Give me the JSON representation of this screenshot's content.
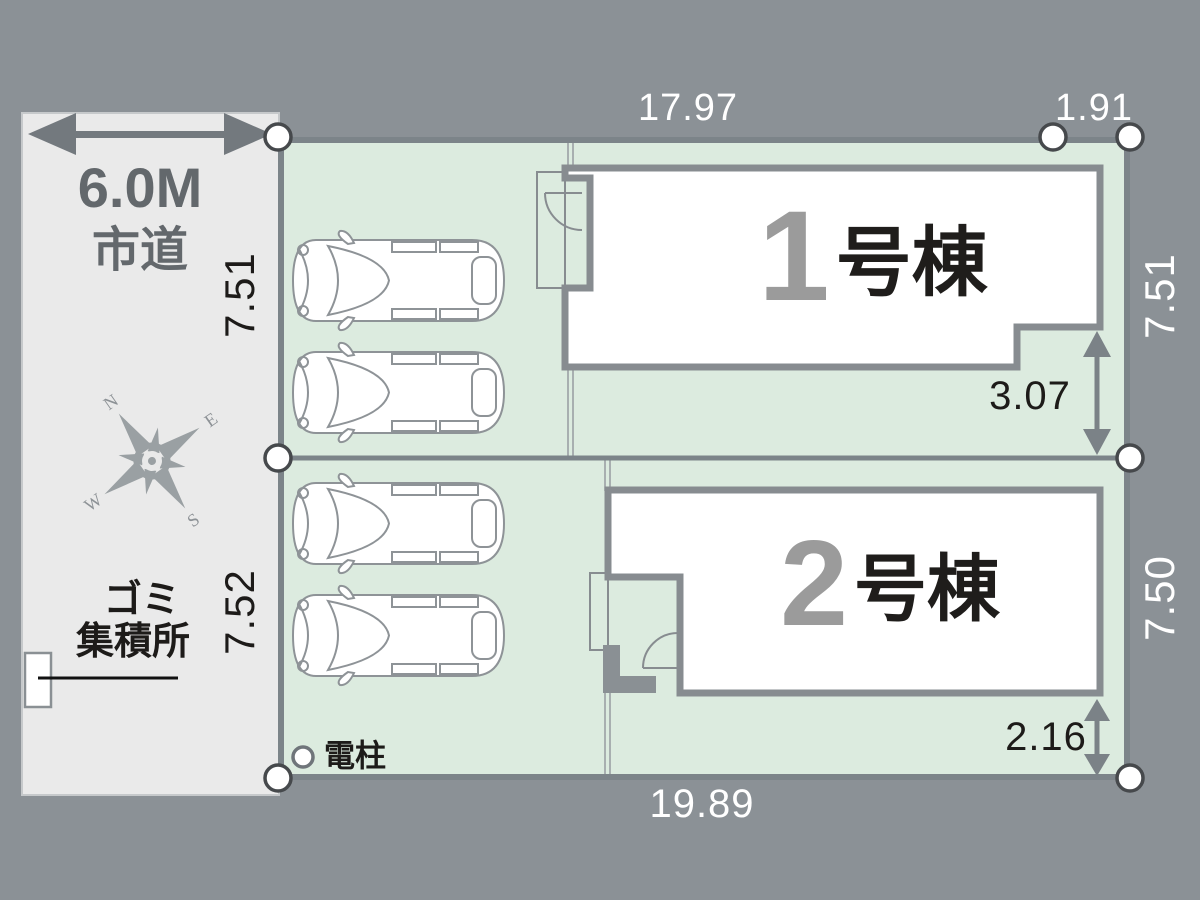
{
  "plan": {
    "title": "site-plan",
    "road": {
      "width_label": "6.0M",
      "type_label": "市道"
    },
    "landmarks": {
      "garbage_line1": "ゴミ",
      "garbage_line2": "集積所",
      "utility_pole": "電柱"
    },
    "compass": {
      "n": "N",
      "e": "E",
      "s": "S",
      "w": "W"
    },
    "buildings": [
      {
        "number": "1",
        "suffix": "号棟"
      },
      {
        "number": "2",
        "suffix": "号棟"
      }
    ],
    "dimensions": {
      "top_main": "17.97",
      "top_right": "1.91",
      "left_upper": "7.51",
      "left_lower": "7.52",
      "right_upper": "7.51",
      "right_lower": "7.50",
      "setback_upper": "3.07",
      "setback_lower": "2.16",
      "bottom": "19.89"
    },
    "colors": {
      "background": "#8b9196",
      "road_fill": "#eaeaea",
      "lot_fill": "#dcebdf",
      "boundary": "#7c8489",
      "building_stroke": "#878c90",
      "arrow": "#757c80",
      "white_text": "#ffffff",
      "black_text": "#1d1b19"
    }
  }
}
